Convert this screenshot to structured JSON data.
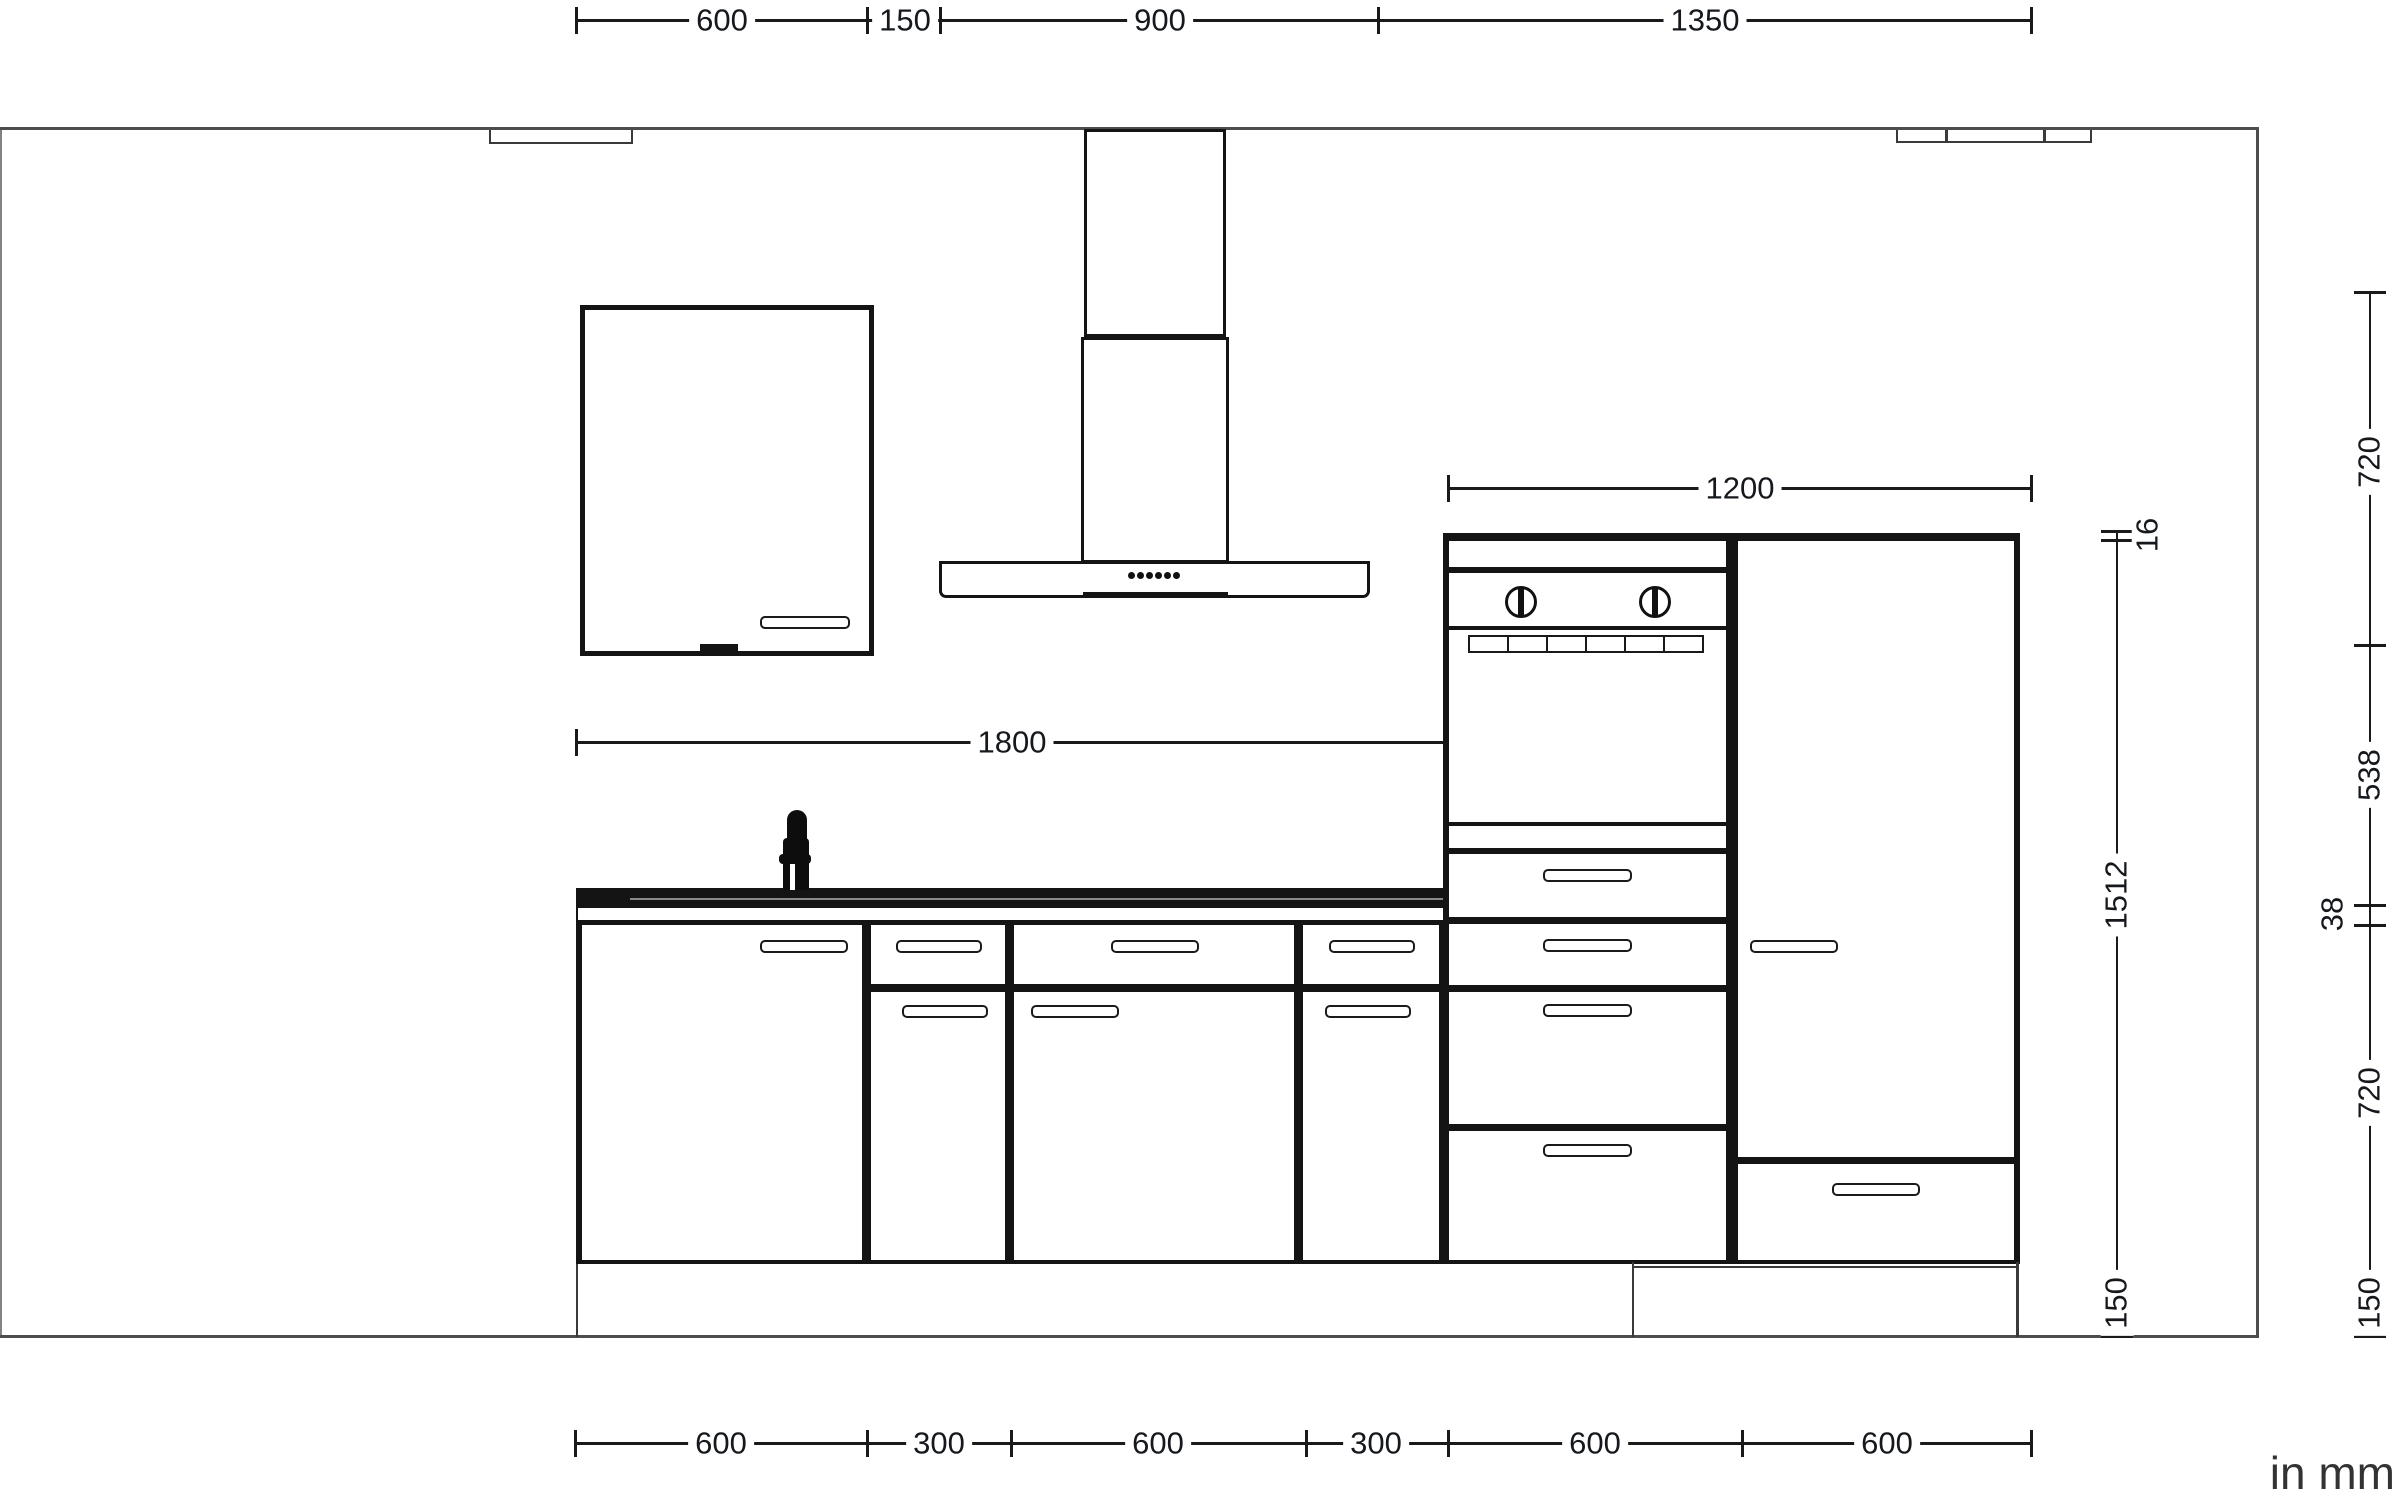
{
  "unit_note": "in mm",
  "colors": {
    "line": "#1a1a1a",
    "wall": "#4d4d4d",
    "panel_gap": "#141414",
    "worktop": "#141414",
    "text": "#15181c"
  },
  "dims": {
    "top": [
      "600",
      "150",
      "900",
      "1350"
    ],
    "bottom": [
      "600",
      "300",
      "600",
      "300",
      "600",
      "600"
    ],
    "hood_width": "1200",
    "base_run_width": "1800",
    "right_outer": [
      "720",
      "538",
      "38",
      "720",
      "150"
    ],
    "right_inner": [
      "16",
      "1512",
      "150"
    ]
  }
}
